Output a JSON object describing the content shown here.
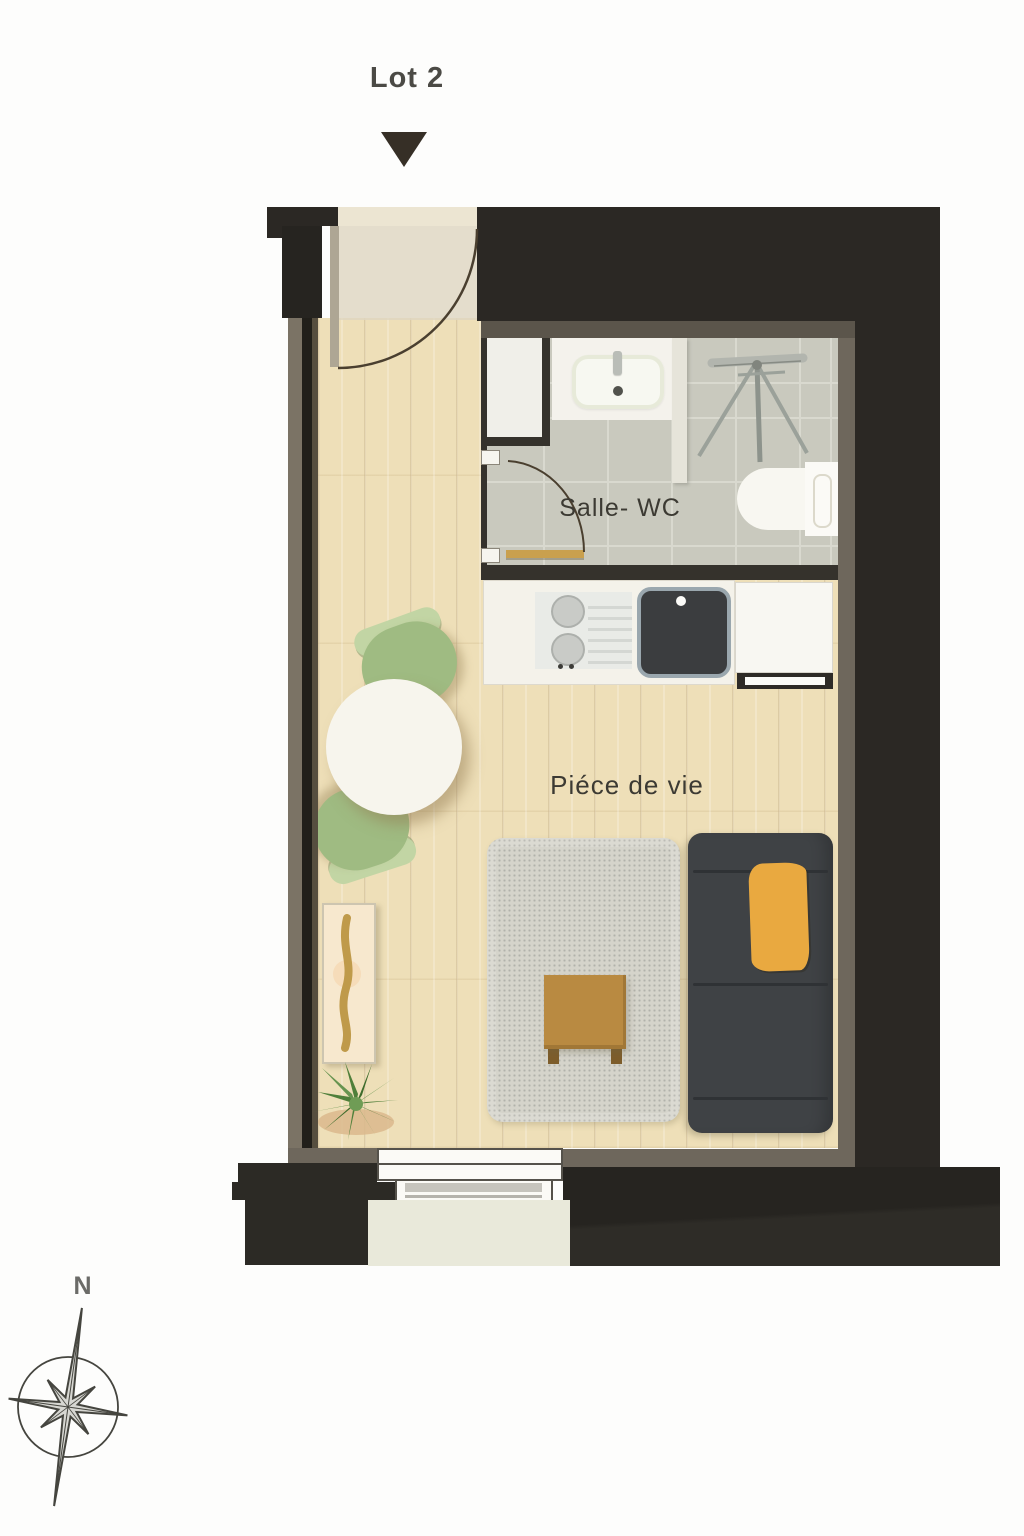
{
  "header": {
    "lot_label": "Lot 2"
  },
  "rooms": {
    "bathroom_label": "Salle- WC",
    "living_label": "Piéce de vie"
  },
  "compass": {
    "north_label": "N"
  },
  "fixtures": [
    "entry-door",
    "bathroom-door",
    "washbasin",
    "drying-rack-tripod",
    "toilet",
    "cooktop",
    "kitchen-sink",
    "kitchen-cabinet",
    "oven-front",
    "dining-table",
    "chair",
    "chair",
    "rug",
    "coffee-table",
    "sofa",
    "throw-blanket",
    "sideboard",
    "plant",
    "window",
    "balcony"
  ],
  "colors": {
    "wall_dark": "#2b2824",
    "wall_lining": "#6e675c",
    "floor_wood": "#eedfb8",
    "bath_tile": "#c9c9be",
    "entry_beige": "#e6dfcb",
    "door_arc": "#4a3f2f",
    "chair_green": "#9fbb82",
    "table_white": "#f7f5ed",
    "rug_gray": "#d5d4cb",
    "sofa_dark": "#3f4245",
    "throw_yellow": "#e9a940",
    "coffee_table_brown": "#b98a41",
    "balcony_cream": "#e9e9da",
    "plant_green": "#57873f"
  }
}
